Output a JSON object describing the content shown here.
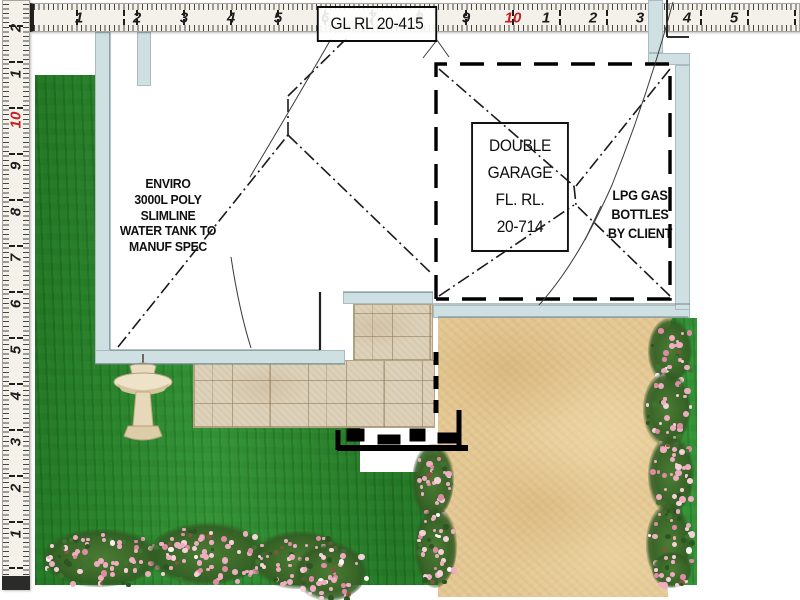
{
  "plan_labels": {
    "ground_level": "GL RL 20-415",
    "garage": [
      "DOUBLE",
      "GARAGE",
      "FL. RL.",
      "20-714"
    ],
    "water_tank_note": [
      "ENVIRO",
      "3000L POLY",
      "SLIMLINE",
      "WATER TANK TO",
      "MANUF SPEC"
    ],
    "lpg_note": [
      "LPG GAS",
      "BOTTLES",
      "BY CLIENT"
    ]
  },
  "rulers": {
    "top": {
      "numbers": [
        "1",
        "2",
        "3",
        "4",
        "5",
        "6",
        "7",
        "8",
        "9",
        "10",
        "1",
        "2",
        "3",
        "4",
        "5"
      ],
      "red_value": "10"
    },
    "left": {
      "numbers_bottom_to_top": [
        "1",
        "2",
        "3",
        "4",
        "5",
        "6",
        "7",
        "8",
        "9",
        "10",
        "1",
        "2"
      ],
      "red_value": "10"
    }
  },
  "colors": {
    "grass": "#2e8c31",
    "sand": "#e4c894",
    "paving": "#ddd1b9",
    "wall": "#cfe0e3",
    "tape": "#f4f1ea",
    "ruler_red": "#c42020",
    "flower_pink": "#eeadc1",
    "flower_pink_light": "#f6d0da",
    "foliage": "#3a6628",
    "line_black": "#111111"
  }
}
